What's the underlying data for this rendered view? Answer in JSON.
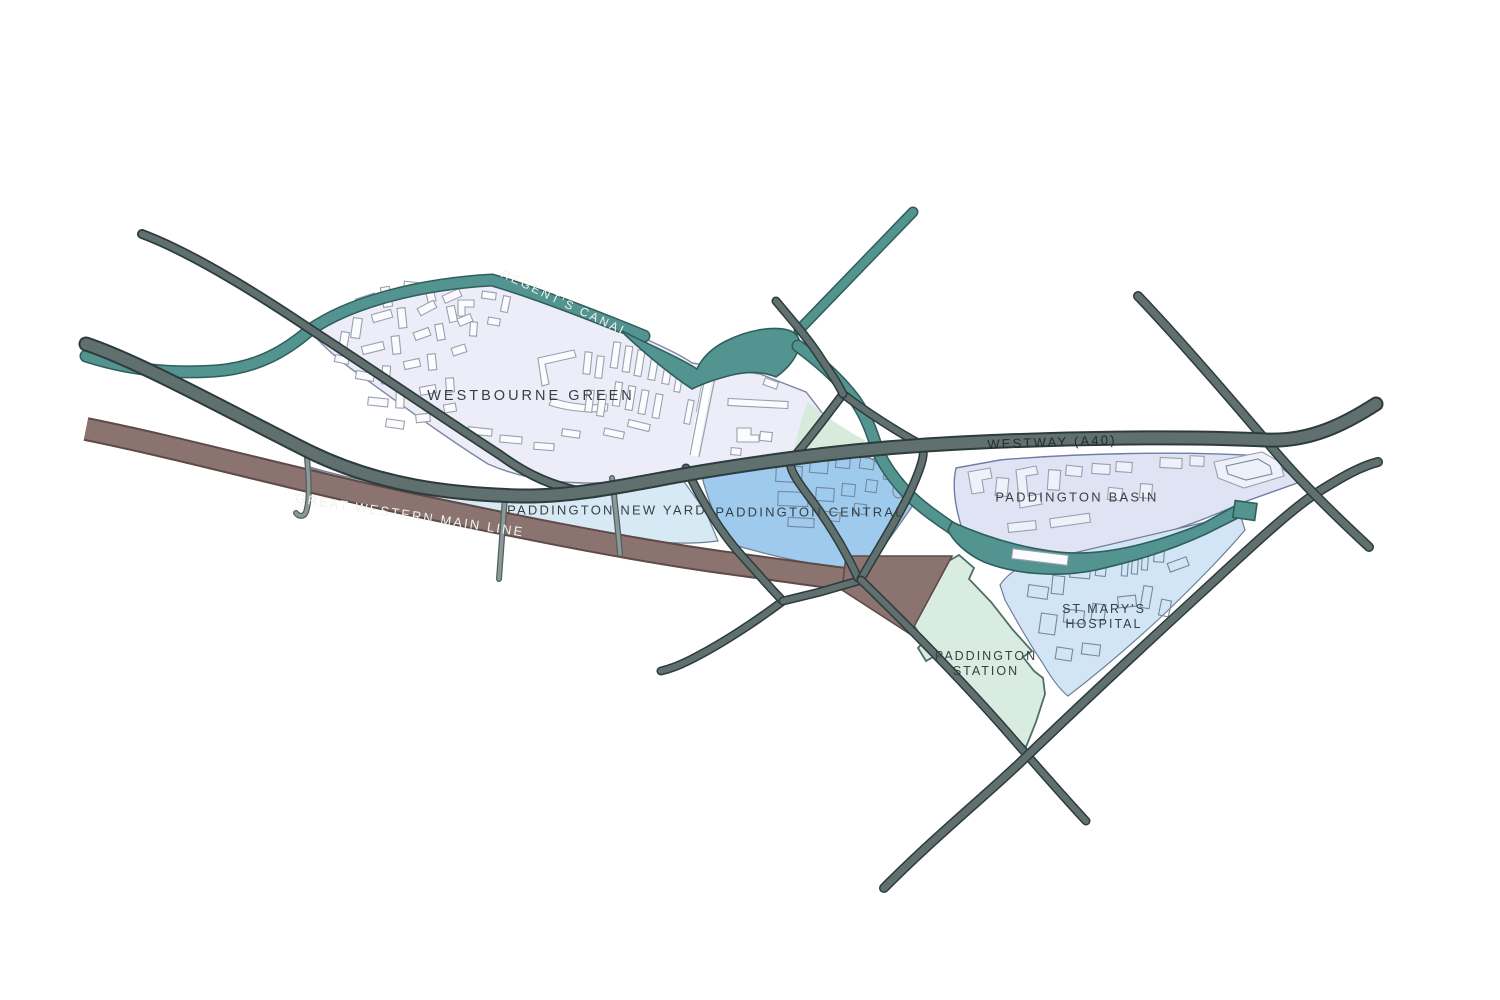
{
  "title": "Paddington area hand-drawn map",
  "map": {
    "labels": {
      "regents_canal": "REGENT'S CANAL",
      "westbourne_green": "WESTBOURNE GREEN",
      "westway": "WESTWAY (A40)",
      "great_western_main_line": "GREAT WESTERN MAIN LINE",
      "paddington_new_yard": "PADDINGTON NEW YARD",
      "paddington_central": "PADDINGTON CENTRAL",
      "paddington_basin": "PADDINGTON BASIN",
      "st_marys_line1": "ST MARY'S",
      "st_marys_line2": "HOSPITAL",
      "station_line1": "PADDINGTON",
      "station_line2": "STATION"
    },
    "colors": {
      "canal": "#539390",
      "canal_edge": "#2e5f5c",
      "rail": "#8b7370",
      "rail_edge": "#5e4a47",
      "road": "#5f706f",
      "road_edge": "#2d3b3c",
      "road_minor": "#8b9a99",
      "road_minor_edge": "#51605f",
      "westbourne_green_fill": "#ecedf8",
      "westbourne_green_edge": "#8087a0",
      "new_yard_fill": "#d8e9f6",
      "central_fill": "#9ecaed",
      "basin_fill": "#dfe3f4",
      "basin_edge": "#707da8",
      "hospital_fill": "#d2e5f6",
      "station_fill": "#d8ece1",
      "station_edge": "#4f6e68",
      "park_fill": "#d8eadc",
      "area_edge": "#6f7f8f",
      "building_stroke": "#99a0ae",
      "building_fill": "#fcfcfe",
      "building_outline2": "#77889c",
      "label_dark": "#373f43",
      "label_light": "#f3f1ee"
    }
  }
}
